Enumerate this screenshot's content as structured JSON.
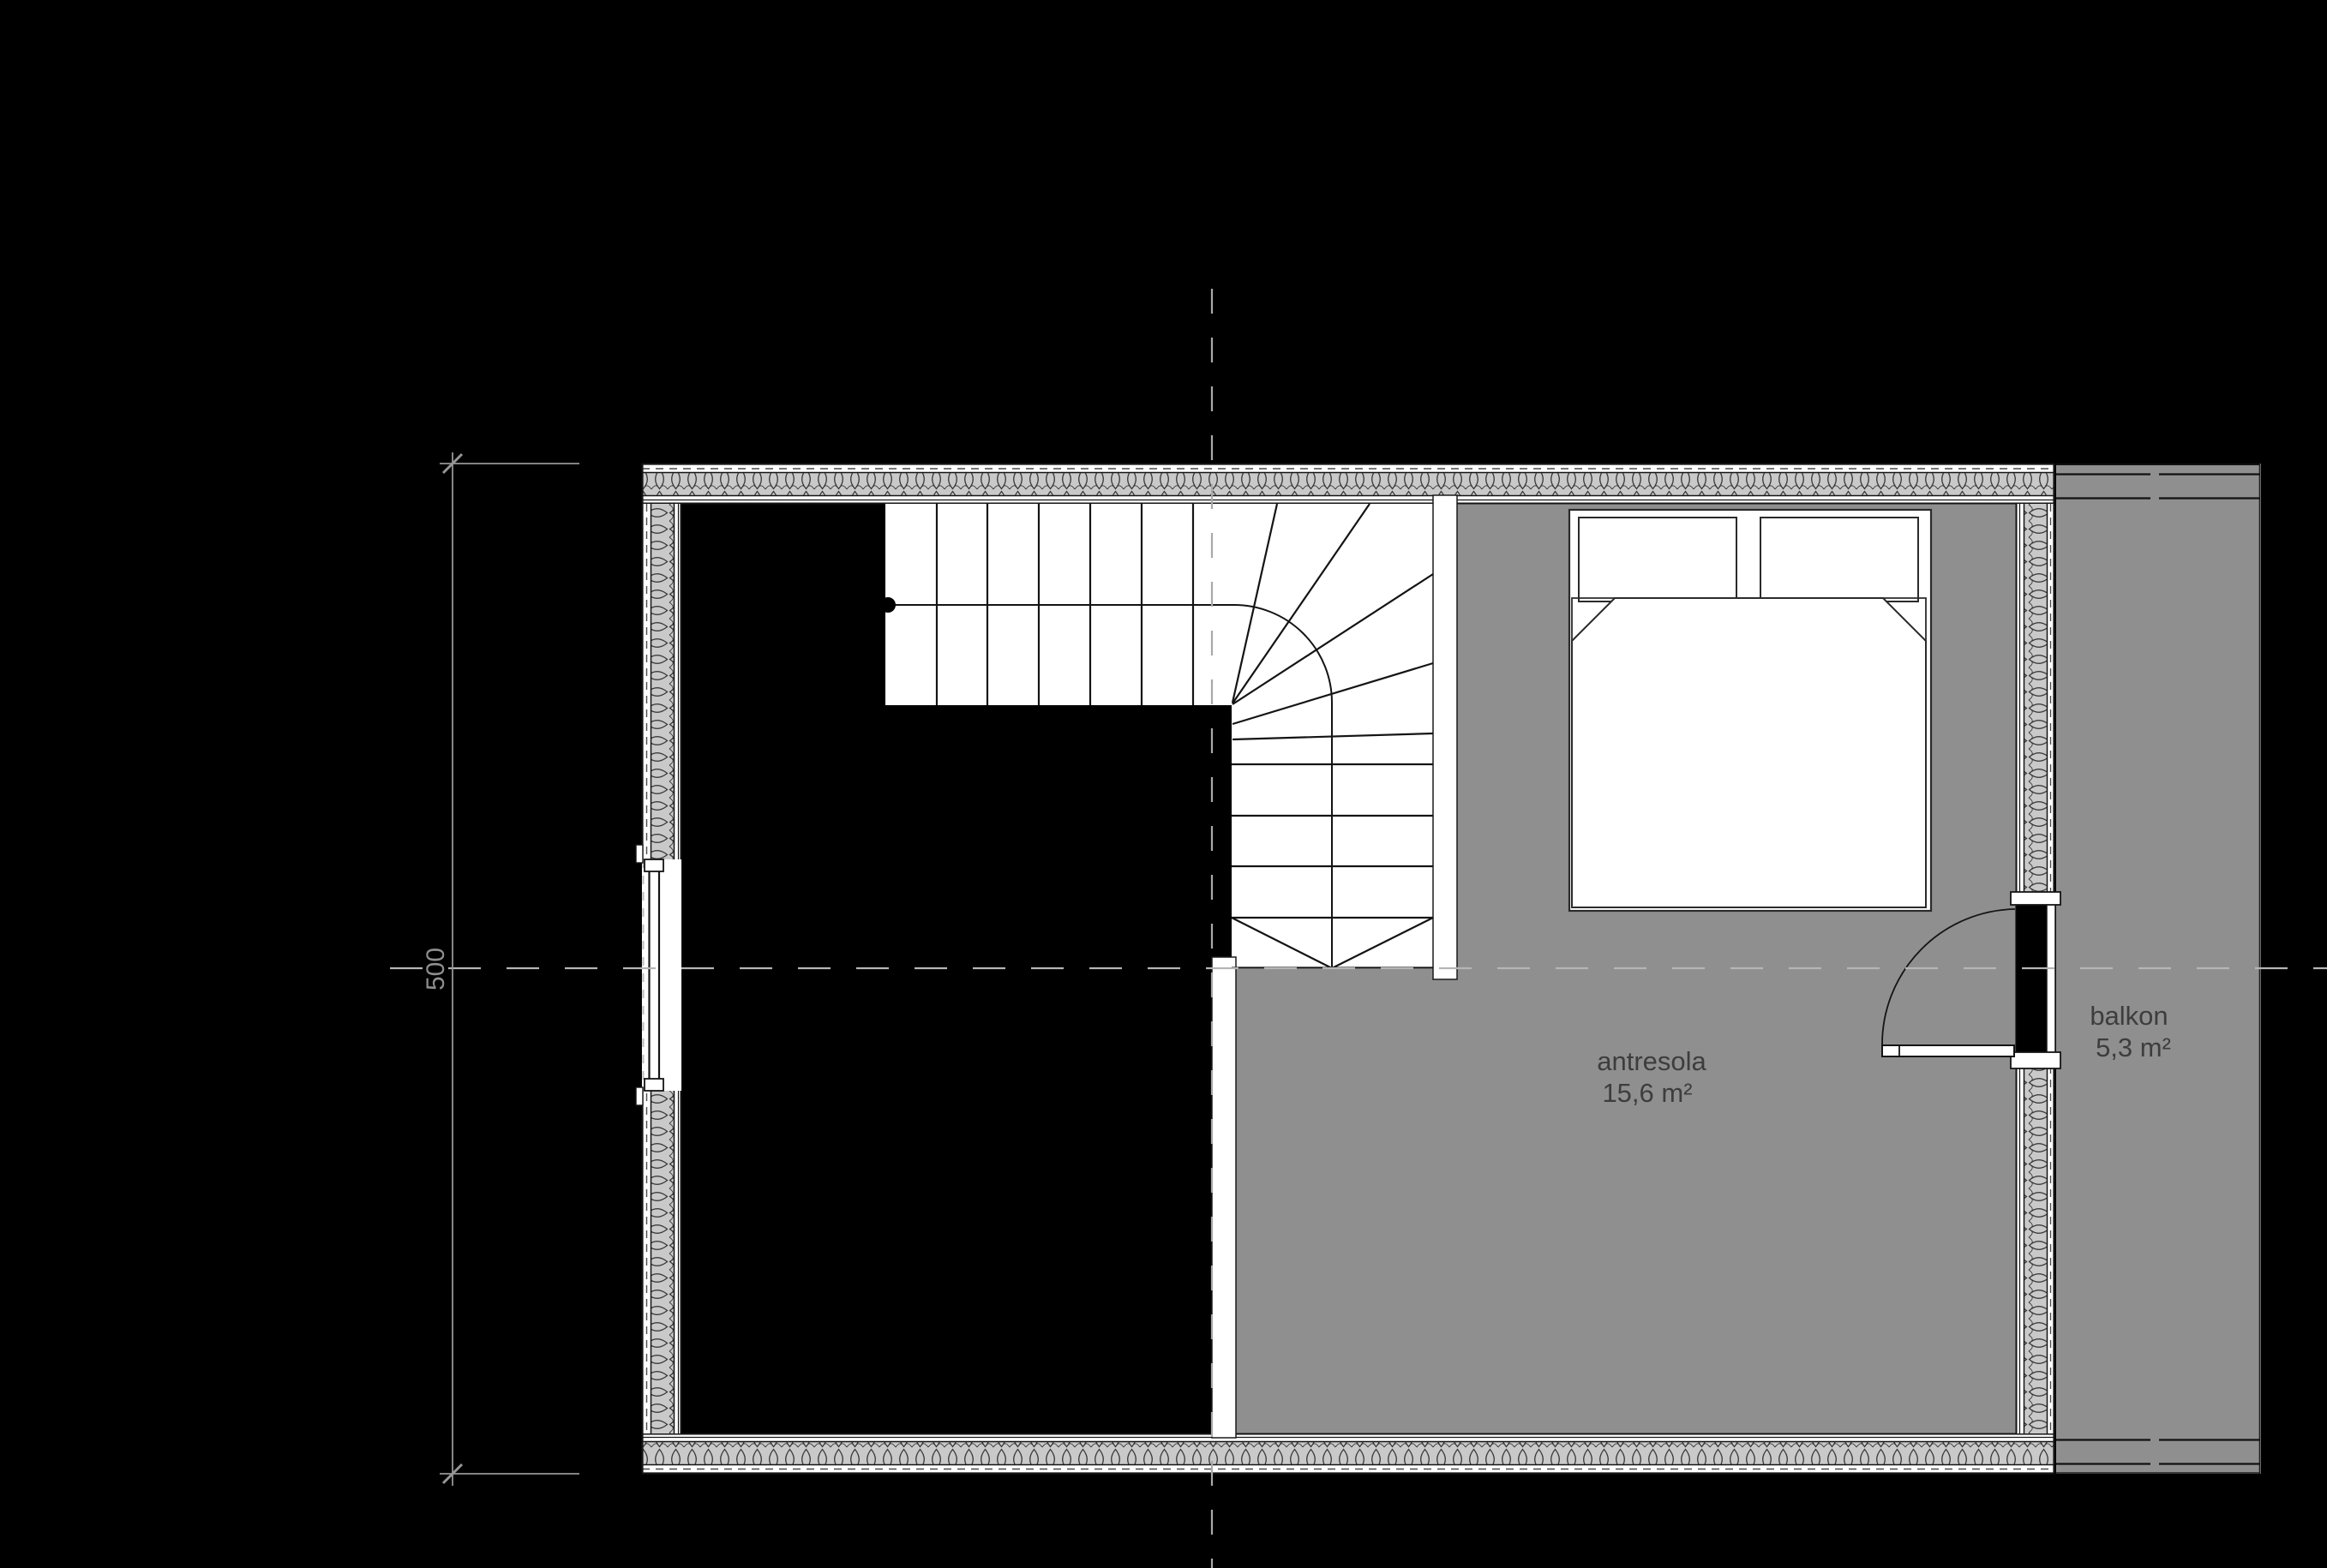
{
  "rooms": [
    {
      "name": "antresola",
      "area": "15,6 m²"
    },
    {
      "name": "balkon",
      "area": "5,3 m²"
    }
  ],
  "dimension": {
    "value": "500"
  },
  "stairs": {
    "upper_flight_tread_lines": 6,
    "winder_tread_lines": 5,
    "lower_flight_tread_lines": 4
  },
  "colors": {
    "background": "#000000",
    "floor_gray": "#8f8f8f",
    "insulation_gray": "#c9c9c9",
    "drawing_line": "#141414",
    "label_text": "#3d3d3d",
    "dimension_gray": "#969696",
    "axis_gray": "#b0b0b0",
    "stair_fill": "#ffffff"
  }
}
